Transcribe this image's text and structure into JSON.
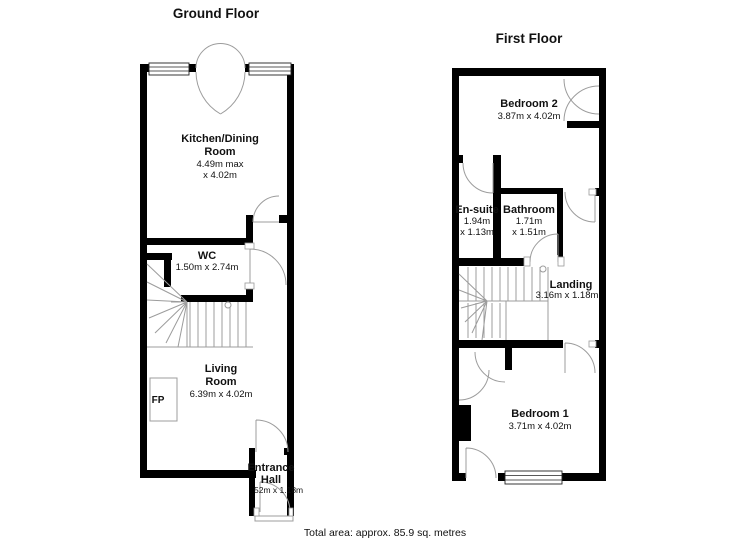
{
  "ground_floor": {
    "title": "Ground Floor",
    "kitchen": {
      "line1": "Kitchen/Dining",
      "line2": "Room",
      "dim1": "4.49m max",
      "dim2": "x 4.02m"
    },
    "wc": {
      "name": "WC",
      "dims": "1.50m x 2.74m"
    },
    "living": {
      "line1": "Living",
      "line2": "Room",
      "dims": "6.39m x 4.02m"
    },
    "entrance": {
      "line1": "Entrance",
      "line2": "Hall",
      "dims": "52m x 1.18m"
    },
    "fireplace": "FP"
  },
  "first_floor": {
    "title": "First Floor",
    "bedroom2": {
      "name": "Bedroom 2",
      "dims": "3.87m x 4.02m"
    },
    "ensuite": {
      "name": "En-suite",
      "dim1": "1.94m",
      "dim2": "x 1.13m"
    },
    "bathroom": {
      "name": "Bathroom",
      "dim1": "1.71m",
      "dim2": "x 1.51m"
    },
    "landing": {
      "name": "Landing",
      "dims": "3.16m x 1.18m"
    },
    "bedroom1": {
      "name": "Bedroom 1",
      "dims": "3.71m x 4.02m"
    }
  },
  "footer": {
    "total_area": "Total area: approx. 85.9 sq. metres"
  },
  "colors": {
    "wall": "#000000",
    "thin_line": "#9c9c9c",
    "background": "#ffffff",
    "text": "#111111"
  }
}
